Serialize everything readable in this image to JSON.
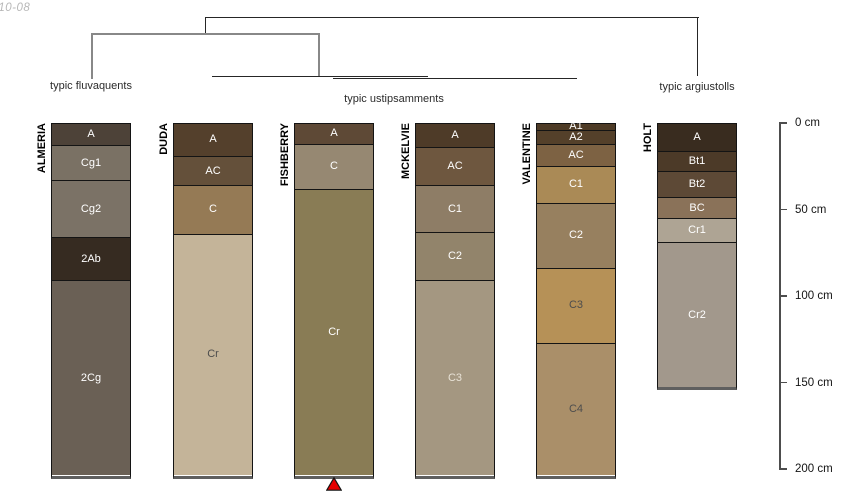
{
  "watermark": "-10-08",
  "figure": {
    "background": "#ffffff",
    "surface_y_px": 123,
    "px_per_cm": 1.73,
    "column_width_px": 80
  },
  "dendrogram": {
    "segments": [
      {
        "x": 205,
        "y": 17,
        "w": 494,
        "h": 1.3,
        "color": "#262626"
      },
      {
        "x": 205,
        "y": 17,
        "w": 1.3,
        "h": 17,
        "color": "#262626"
      },
      {
        "x": 697,
        "y": 17,
        "w": 1.3,
        "h": 59,
        "color": "#262626"
      },
      {
        "x": 91,
        "y": 32.5,
        "w": 229,
        "h": 2,
        "color": "#888888"
      },
      {
        "x": 91,
        "y": 32.5,
        "w": 2,
        "h": 46,
        "color": "#888888"
      },
      {
        "x": 318,
        "y": 32.5,
        "w": 2,
        "h": 44,
        "color": "#888888"
      },
      {
        "x": 212,
        "y": 76,
        "w": 216,
        "h": 1.2,
        "color": "#262626"
      },
      {
        "x": 333,
        "y": 77.5,
        "w": 244,
        "h": 1.2,
        "color": "#262626"
      }
    ],
    "labels": [
      {
        "text": "typic fluvaquents",
        "x": 91,
        "y": 80
      },
      {
        "text": "typic ustipsamments",
        "x": 394,
        "y": 93
      },
      {
        "text": "typic argiustolls",
        "x": 697,
        "y": 81
      }
    ]
  },
  "depth_axis": {
    "x": 779,
    "top_cm": 0,
    "bottom_cm": 200,
    "ticks": [
      {
        "cm": 0,
        "label": "0 cm"
      },
      {
        "cm": 50,
        "label": "50 cm"
      },
      {
        "cm": 100,
        "label": "100 cm"
      },
      {
        "cm": 150,
        "label": "150 cm"
      },
      {
        "cm": 200,
        "label": "200 cm"
      }
    ]
  },
  "chart_data": {
    "type": "soil-profile-sketches-with-dendrogram",
    "depth_unit": "cm",
    "profiles": [
      {
        "id": "ALMERIA",
        "group": "typic fluvaquents",
        "center_x": 91,
        "horizons": [
          {
            "name": "A",
            "top": 0,
            "bottom": 13,
            "color": "#4d4238",
            "label_color": "#ffffff"
          },
          {
            "name": "Cg1",
            "top": 13,
            "bottom": 33,
            "color": "#7a7164",
            "label_color": "#ffffff"
          },
          {
            "name": "Cg2",
            "top": 33,
            "bottom": 66,
            "color": "#7b7266",
            "label_color": "#ffffff"
          },
          {
            "name": "2Ab",
            "top": 66,
            "bottom": 91,
            "color": "#362b21",
            "label_color": "#ffffff"
          },
          {
            "name": "2Cg",
            "top": 91,
            "bottom": 203,
            "color": "#6a6055",
            "label_color": "#ffffff"
          }
        ]
      },
      {
        "id": "DUDA",
        "group": "typic ustipsamments",
        "center_x": 213,
        "horizons": [
          {
            "name": "A",
            "top": 0,
            "bottom": 19,
            "color": "#54402c",
            "label_color": "#ffffff"
          },
          {
            "name": "AC",
            "top": 19,
            "bottom": 36,
            "color": "#64503a",
            "label_color": "#ffffff"
          },
          {
            "name": "C",
            "top": 36,
            "bottom": 64,
            "color": "#957a55",
            "label_color": "#ffffff"
          },
          {
            "name": "Cr",
            "top": 64,
            "bottom": 203,
            "color": "#c4b499",
            "label_color": "#4d4d4d"
          }
        ]
      },
      {
        "id": "FISHBERRY",
        "group": "typic ustipsamments",
        "center_x": 334,
        "horizons": [
          {
            "name": "A",
            "top": 0,
            "bottom": 12,
            "color": "#5e4936",
            "label_color": "#ffffff"
          },
          {
            "name": "C",
            "top": 12,
            "bottom": 38,
            "color": "#968872",
            "label_color": "#ffffff"
          },
          {
            "name": "Cr",
            "top": 38,
            "bottom": 203,
            "color": "#897c55",
            "label_color": "#ffffff"
          }
        ]
      },
      {
        "id": "MCKELVIE",
        "group": "typic ustipsamments",
        "center_x": 455,
        "horizons": [
          {
            "name": "A",
            "top": 0,
            "bottom": 14,
            "color": "#4e3b28",
            "label_color": "#ffffff"
          },
          {
            "name": "AC",
            "top": 14,
            "bottom": 36,
            "color": "#6e573f",
            "label_color": "#ffffff"
          },
          {
            "name": "C1",
            "top": 36,
            "bottom": 63,
            "color": "#8e7d66",
            "label_color": "#ffffff"
          },
          {
            "name": "C2",
            "top": 63,
            "bottom": 91,
            "color": "#92846b",
            "label_color": "#ffffff"
          },
          {
            "name": "C3",
            "top": 91,
            "bottom": 203,
            "color": "#a49781",
            "label_color": "#e8e2d6"
          }
        ]
      },
      {
        "id": "VALENTINE",
        "group": "typic ustipsamments",
        "center_x": 576,
        "horizons": [
          {
            "name": "A1",
            "top": 0,
            "bottom": 4,
            "color": "#4e3b26",
            "label_color": "#ffffff"
          },
          {
            "name": "A2",
            "top": 4,
            "bottom": 12,
            "color": "#54402a",
            "label_color": "#ffffff"
          },
          {
            "name": "AC",
            "top": 12,
            "bottom": 25,
            "color": "#7d6243",
            "label_color": "#ffffff"
          },
          {
            "name": "C1",
            "top": 25,
            "bottom": 46,
            "color": "#aa8a56",
            "label_color": "#ffffff"
          },
          {
            "name": "C2",
            "top": 46,
            "bottom": 84,
            "color": "#97805f",
            "label_color": "#ffffff"
          },
          {
            "name": "C3",
            "top": 84,
            "bottom": 127,
            "color": "#b69157",
            "label_color": "#4d4d4d"
          },
          {
            "name": "C4",
            "top": 127,
            "bottom": 203,
            "color": "#aa8f69",
            "label_color": "#4d4d4d"
          }
        ]
      },
      {
        "id": "HOLT",
        "group": "typic argiustolls",
        "center_x": 697,
        "horizons": [
          {
            "name": "A",
            "top": 0,
            "bottom": 16,
            "color": "#392c1f",
            "label_color": "#ffffff"
          },
          {
            "name": "Bt1",
            "top": 16,
            "bottom": 28,
            "color": "#4c3a28",
            "label_color": "#ffffff"
          },
          {
            "name": "Bt2",
            "top": 28,
            "bottom": 43,
            "color": "#5d4936",
            "label_color": "#ffffff"
          },
          {
            "name": "BC",
            "top": 43,
            "bottom": 55,
            "color": "#8a7259",
            "label_color": "#ffffff"
          },
          {
            "name": "Cr1",
            "top": 55,
            "bottom": 69,
            "color": "#aea494",
            "label_color": "#ffffff"
          },
          {
            "name": "Cr2",
            "top": 69,
            "bottom": 152,
            "color": "#a2988c",
            "label_color": "#ffffff"
          }
        ]
      }
    ],
    "marker": {
      "shape": "triangle-up",
      "profile": "FISHBERRY",
      "color": "#e60000",
      "outline": "#141414"
    }
  }
}
